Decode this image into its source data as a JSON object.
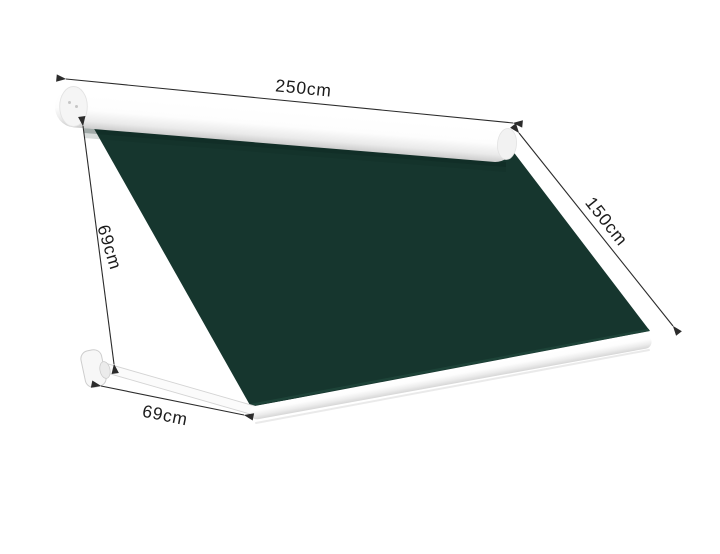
{
  "diagram": {
    "subject": "retractable drop-arm awning with dimension annotations",
    "labels": {
      "width": "250cm",
      "projection": "150cm",
      "drop": "69cm",
      "arm_length": "69cm"
    },
    "colors": {
      "background": "#ffffff",
      "fabric": "#16362e",
      "fabric_edge_highlight": "#1e4539",
      "frame": "#ffffff",
      "frame_shading": "#cccccc",
      "dimension_line": "#2b2b2b",
      "label_text": "#1c1c1c"
    }
  }
}
